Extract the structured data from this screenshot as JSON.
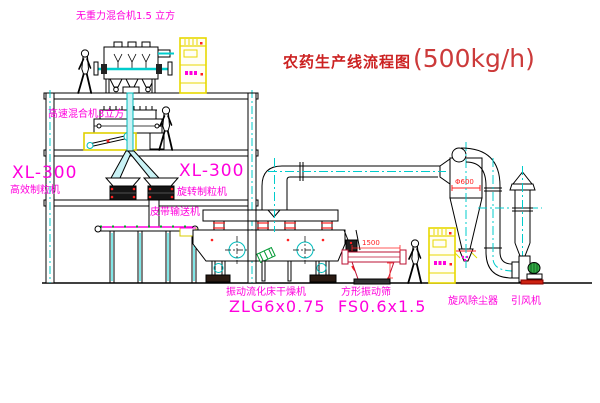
{
  "title": {
    "prefix": "农药生产线流程图",
    "capacity": "(500kg/h)"
  },
  "labels": {
    "gravity_mixer": "无重力混合机1.5 立方",
    "speed_mixer": "高速混合机3立方",
    "granulator_left_model": "XL-300",
    "granulator_left_name": "高效制粒机",
    "granulator_right_model": "XL-300",
    "granulator_right_name": "旋转制粒机",
    "belt_conveyor": "皮带输送机",
    "dryer_name": "振动流化床干燥机",
    "dryer_model": "ZLG6x0.75",
    "sieve_name": "方形振动筛",
    "sieve_model": "FS0.6x1.5",
    "cyclone": "旋风除尘器",
    "fan": "引风机"
  },
  "dimensions": {
    "sieve_length": "1500",
    "cyclone_diameter": "Φ600"
  },
  "colors": {
    "line": "#000000",
    "centerline_cyan": "#00cccc",
    "pipe_fill": "#c9f2f5",
    "label_magenta": "#ff00dd",
    "title_red": "#cc2222",
    "detail_red": "#ff2222",
    "cabinet_yellow": "#e8d800",
    "motor_green": "#22aa44"
  }
}
